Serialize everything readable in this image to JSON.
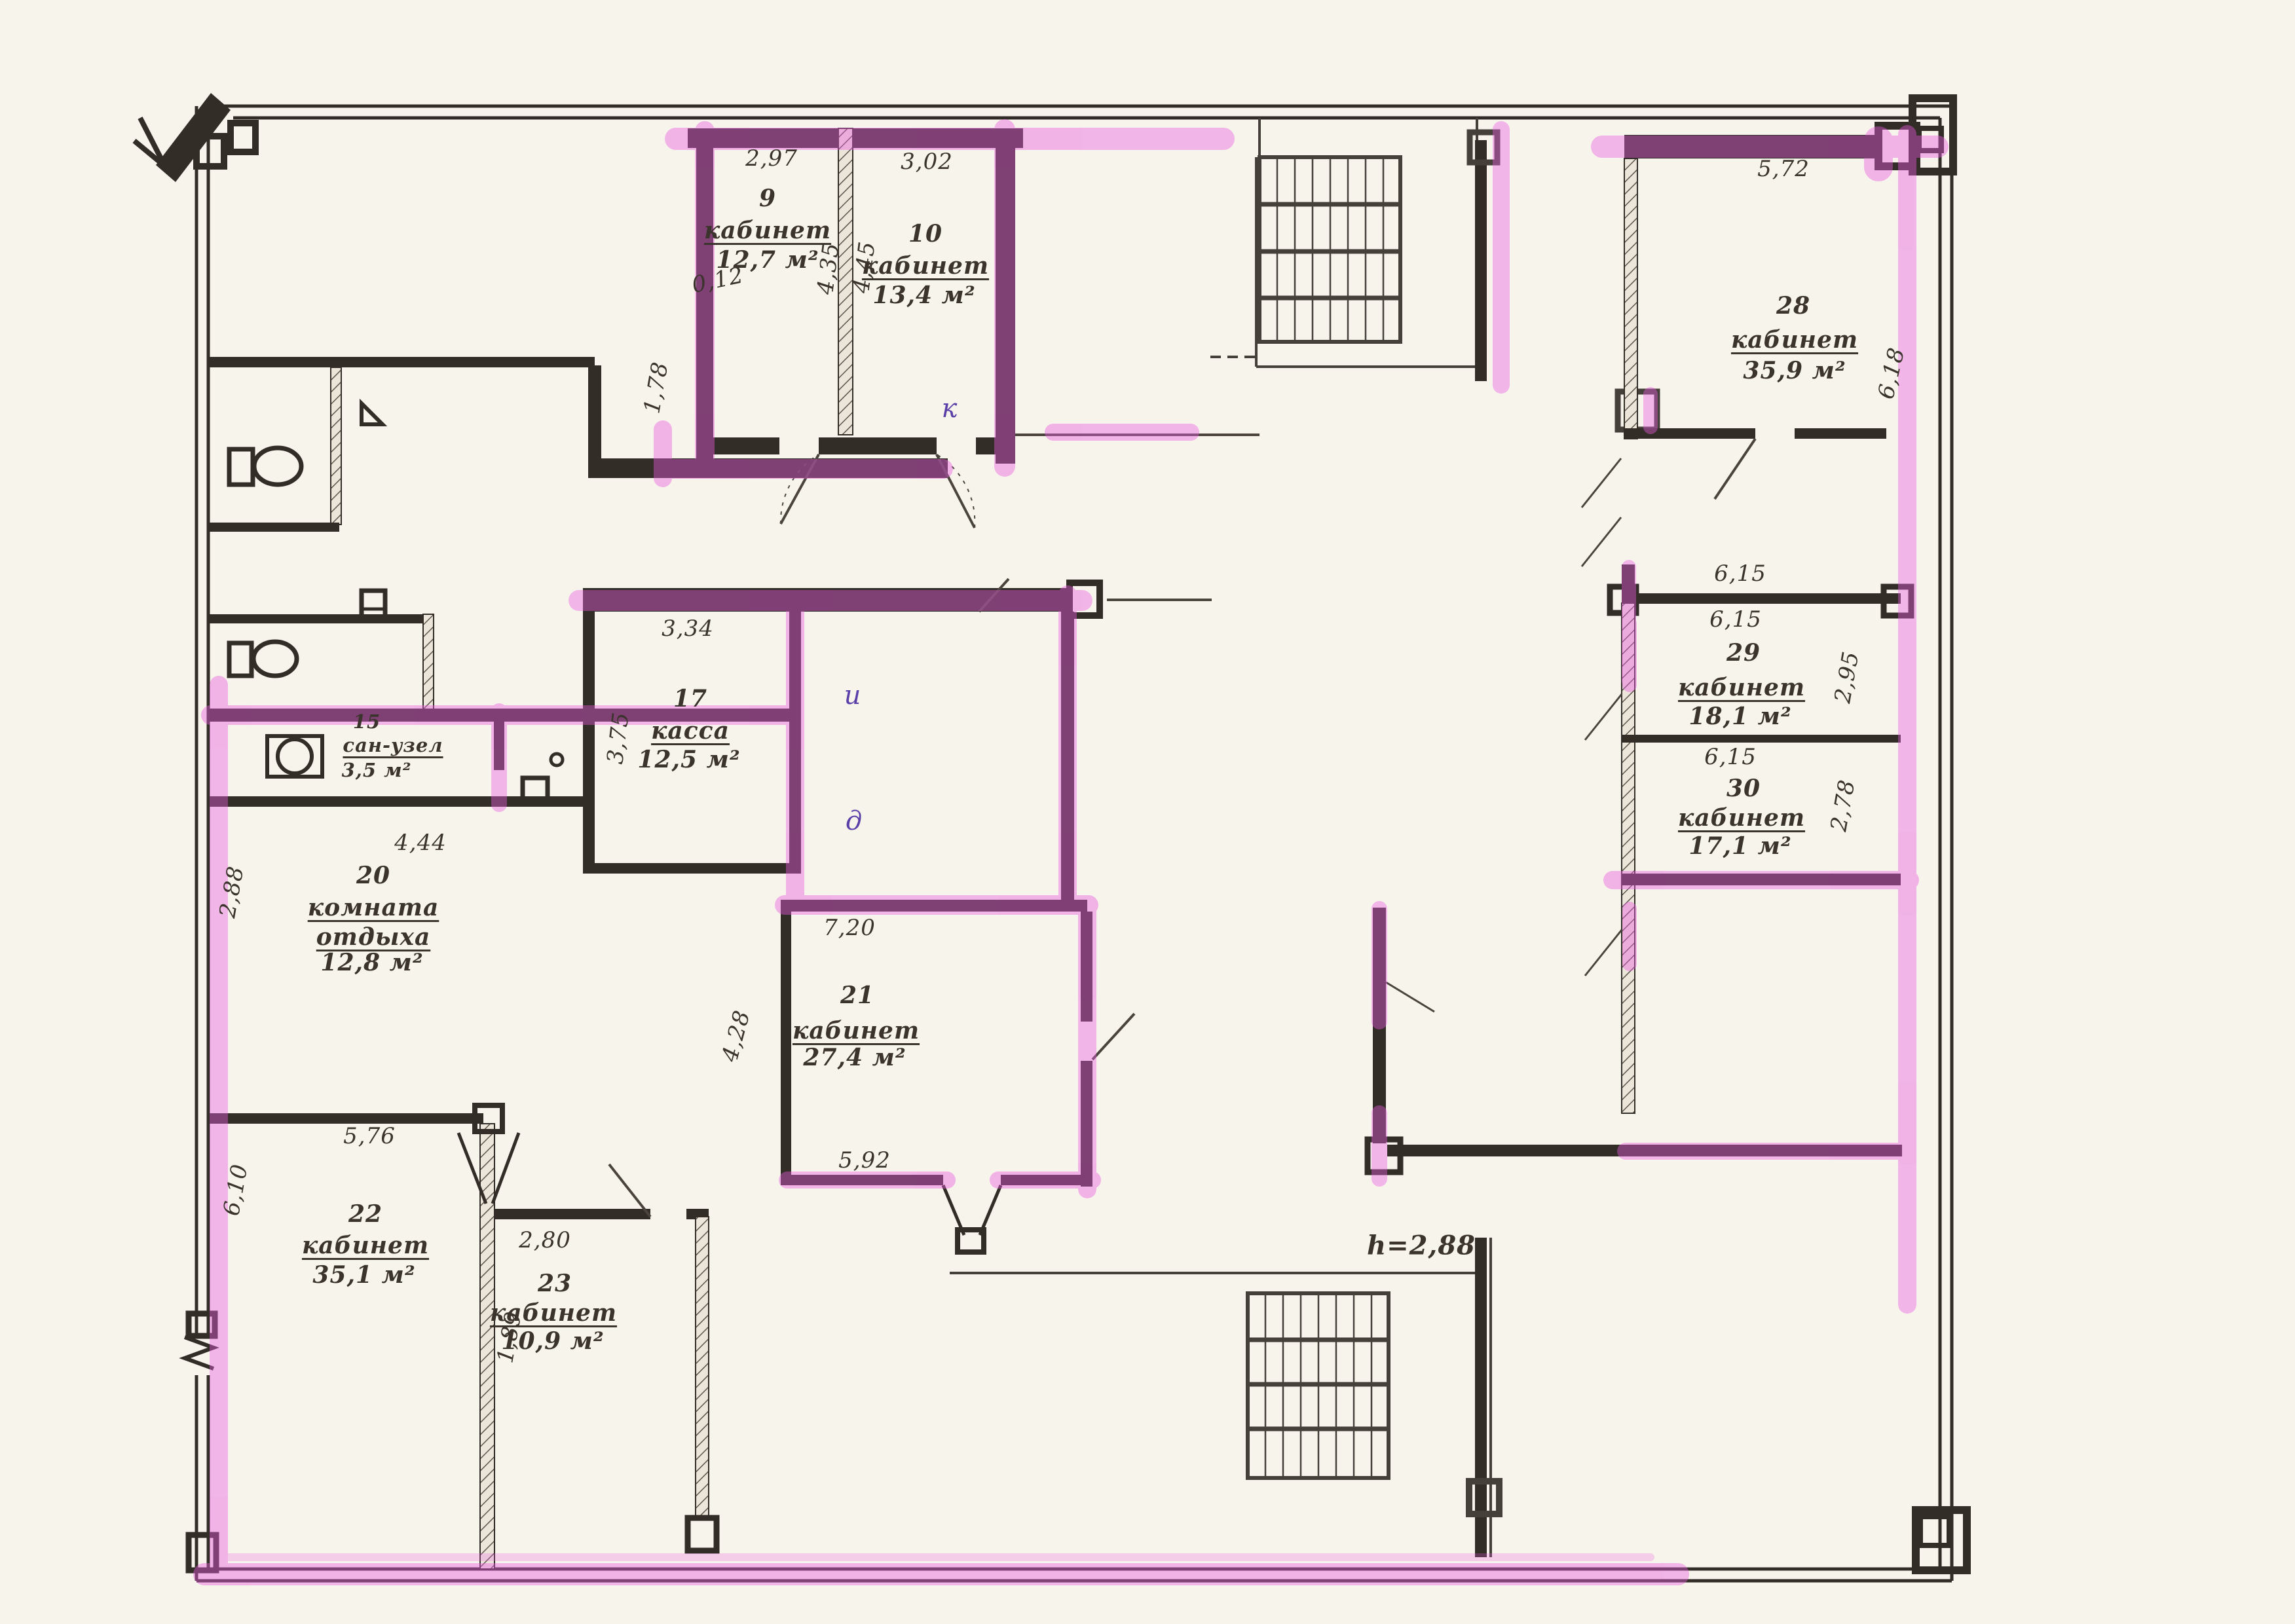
{
  "document": {
    "kind": "scanned floor plan",
    "language": "ru",
    "highlight_color": "#ea5ce0",
    "ink_color": "#3b342c"
  },
  "labels": {
    "r9": {
      "dim_w": "2,97",
      "num": "9",
      "name": "кабинет",
      "area": "12,7 м²",
      "dim_h": "4,35",
      "dim_small": "0,12"
    },
    "r10": {
      "dim_w": "3,02",
      "num": "10",
      "name": "кабинет",
      "area": "13,4 м²",
      "dim_h": "4,45"
    },
    "r15": {
      "num": "15",
      "name": "сан-узел",
      "area": "3,5 м²"
    },
    "r17": {
      "dim_w": "3,34",
      "num": "17",
      "name": "касса",
      "area": "12,5 м²",
      "dim_h": "3,75"
    },
    "r20": {
      "num": "20",
      "name1": "комната",
      "name2": "отдыха",
      "area": "12,8 м²",
      "dim_w": "4,44",
      "dim_h": "2,88"
    },
    "r21": {
      "dim_w": "7,20",
      "num": "21",
      "name": "кабинет",
      "area": "27,4 м²",
      "dim_h": "4,28",
      "dim_s": "5,92"
    },
    "r22": {
      "num": "22",
      "name": "кабинет",
      "area": "35,1 м²",
      "dim_w": "5,76",
      "dim_h": "6,10"
    },
    "r23": {
      "dim_w": "2,80",
      "num": "23",
      "name": "кабинет",
      "area": "10,9 м²",
      "dim_h": "1,89"
    },
    "r28": {
      "dim_w": "5,72",
      "num": "28",
      "name": "кабинет",
      "area": "35,9 м²",
      "dim_h": "6,18"
    },
    "r29": {
      "dim_above": "6,15",
      "dim_below": "6,15",
      "num": "29",
      "name": "кабинет",
      "area": "18,1 м²",
      "dim_h": "2,95"
    },
    "r30": {
      "dim_w": "6,15",
      "num": "30",
      "name": "кабинет",
      "area": "17,1 м²",
      "dim_h": "2,78"
    },
    "misc": {
      "dim_178": "1,78",
      "height_note": "h=2,88"
    },
    "pen": {
      "mark1": "и",
      "mark2": "д",
      "mark3": "к"
    }
  }
}
